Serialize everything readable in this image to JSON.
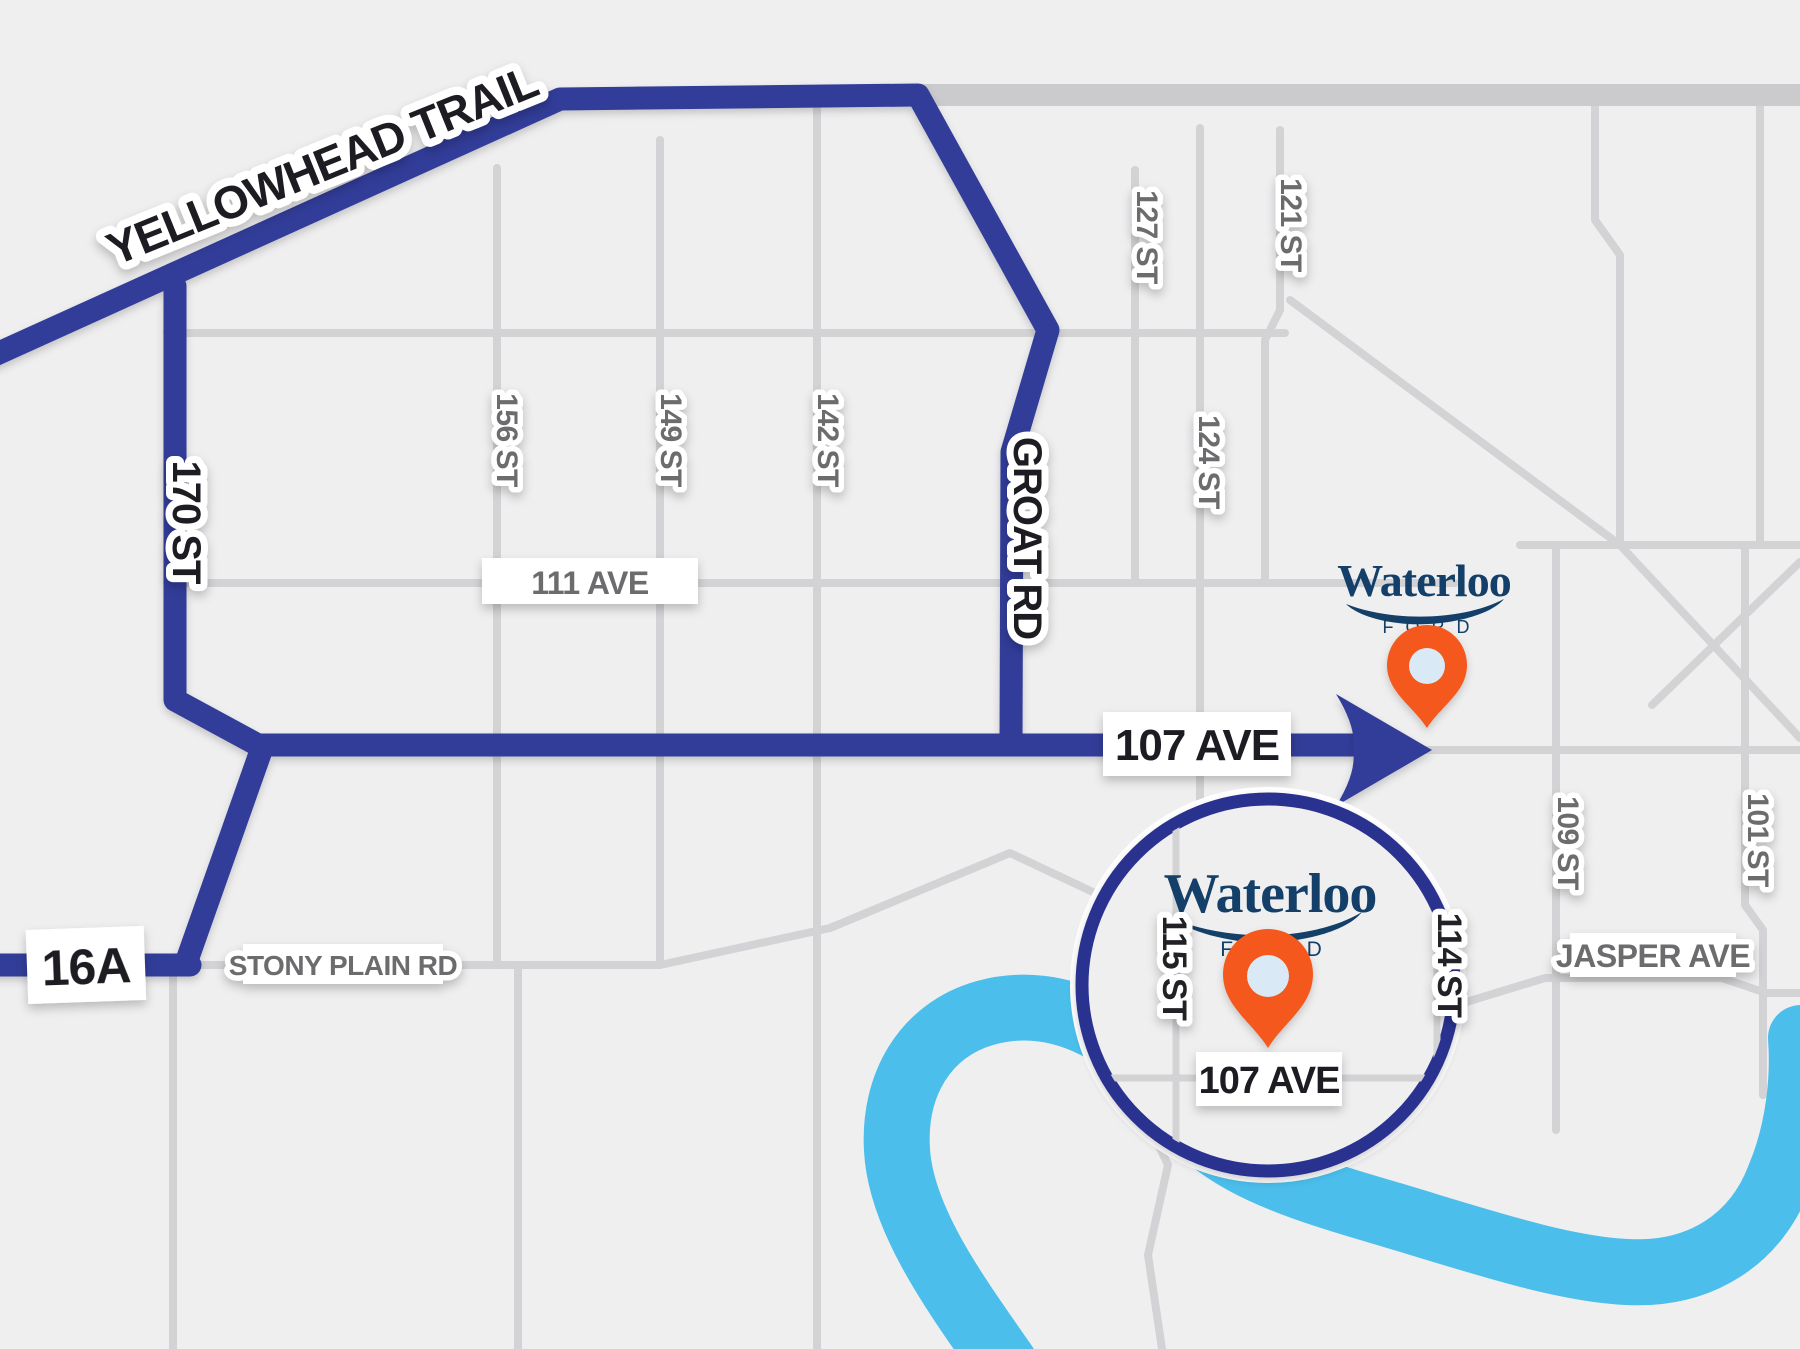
{
  "map_title": "Waterloo Ford location map - Edmonton",
  "labels": {
    "yellowhead": "YELLOWHEAD TRAIL",
    "st170": "170 ST",
    "groat": "GROAT RD",
    "ave107_main": "107 AVE",
    "hwy16a": "16A",
    "stony_plain": "STONY PLAIN RD",
    "ave111": "111 AVE",
    "st156": "156 ST",
    "st149": "149 ST",
    "st142": "142 ST",
    "st127": "127 ST",
    "st121": "121 ST",
    "st124": "124 ST",
    "st109": "109 ST",
    "st101": "101 ST",
    "jasper": "JASPER AVE"
  },
  "inset": {
    "st115": "115 ST",
    "st114": "114 ST",
    "ave107": "107 AVE"
  },
  "brand": {
    "name": "Waterloo",
    "sub": "FORD"
  },
  "colors": {
    "bg": "#EFEFF0",
    "road": "#D3D3D5",
    "road_thick": "#CBCBCE",
    "route_blue": "#323E99",
    "circle_border": "#2B3190",
    "river": "#4BBEEB",
    "pin_orange": "#F4581C",
    "pin_hole": "#D9EAF6",
    "brand_navy": "#143F68",
    "street_label_gray": "#6C6C6E",
    "route_label_black": "#1E1E20",
    "label_bg": "#FFFFFF"
  }
}
